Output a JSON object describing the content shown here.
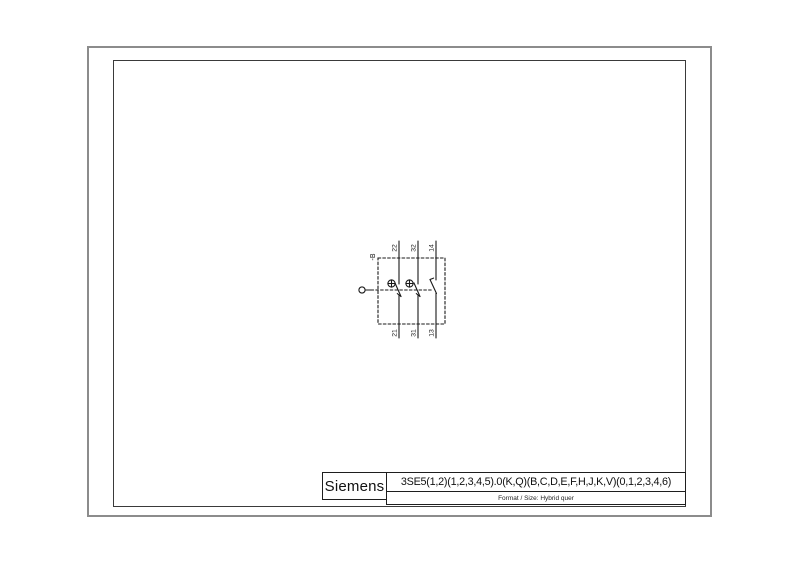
{
  "sheet": {
    "background_color": "#ffffff",
    "outer_border_color": "#8c8c8c",
    "frame_color": "#3a3a3a",
    "line_color": "#1a1a1a"
  },
  "title_block": {
    "brand": "Siemens",
    "part_number": "3SE5(1,2)(1,2,3,4,5).0(K,Q)(B,C,D,E,F,H,J,K,V)(0,1,2,3,4,6)",
    "format_size": "Format / Size:  Hybrid quer"
  },
  "schematic": {
    "device_label": "-B",
    "terminals_top": [
      "22",
      "32",
      "14"
    ],
    "terminals_bottom": [
      "21",
      "31",
      "13"
    ],
    "contacts": [
      {
        "top": "22",
        "bottom": "21",
        "type": "NC positive-opening"
      },
      {
        "top": "32",
        "bottom": "31",
        "type": "NC positive-opening"
      },
      {
        "top": "14",
        "bottom": "13",
        "type": "NO"
      }
    ],
    "icons": {
      "positive_opening": "circled-plus",
      "actuator": "plunger-circle",
      "mechanical_link": "dashed-line"
    }
  }
}
